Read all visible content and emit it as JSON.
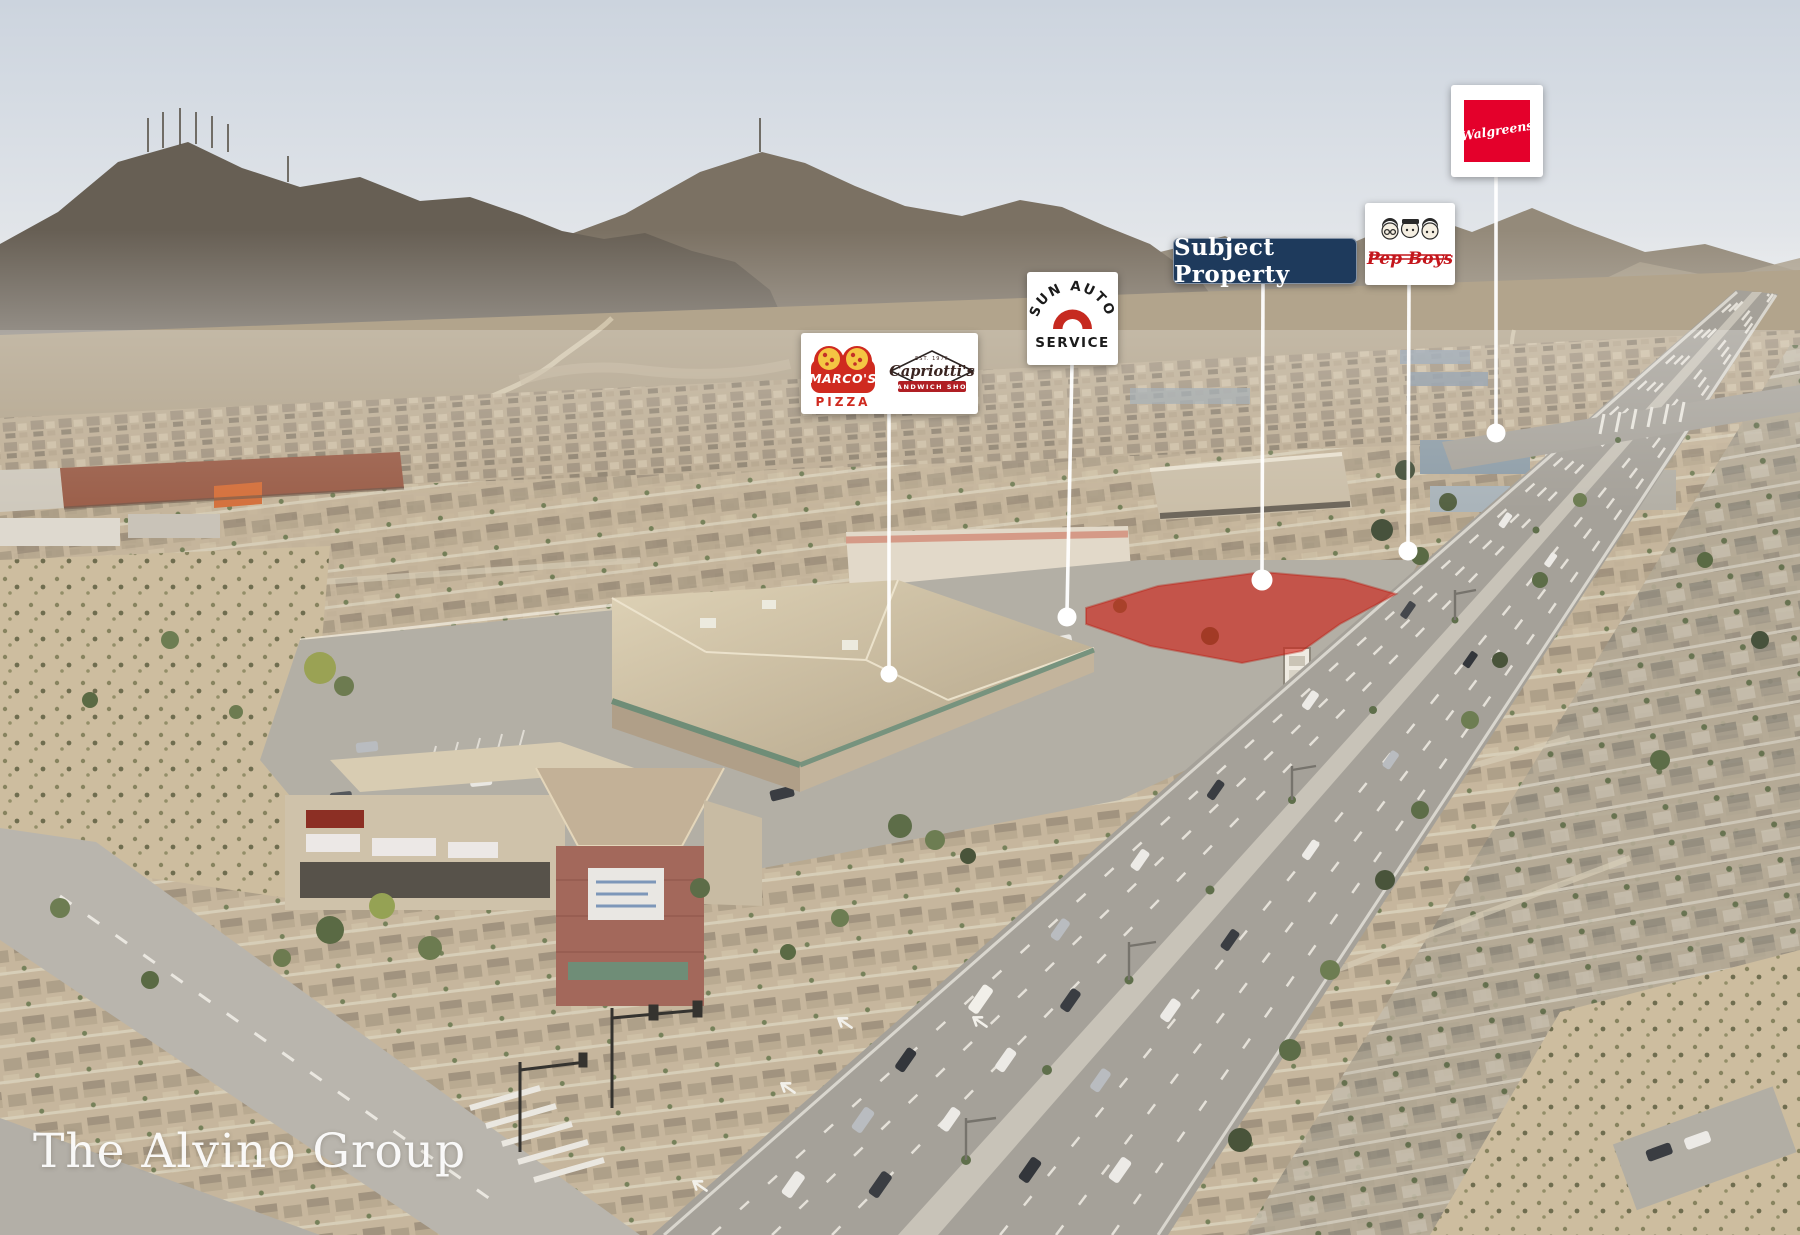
{
  "watermark": {
    "text": "The Alvino Group"
  },
  "callouts": {
    "subject_property": {
      "label": "Subject Property"
    },
    "walgreens": {
      "label": "Walgreens"
    },
    "pep_boys": {
      "label": "Pep Boys"
    },
    "sun_auto": {
      "arc_text": "SUN AUTO",
      "service_text": "SERVICE"
    },
    "marcos": {
      "name": "MARCO'S",
      "product": "PIZZA"
    },
    "capriottis": {
      "est": "EST. 1976",
      "name": "Capriotti's",
      "banner": "SANDWICH SHOP"
    }
  },
  "highlight": {
    "color": "#cf1d12",
    "subject_label_bg": "#1e3a5c",
    "walgreens_red": "#e4002b",
    "pepboys_red": "#c4161c",
    "marcos_red": "#cf2a1f",
    "sunauto_red": "#c62a20",
    "capriottis_red": "#b01f24"
  }
}
